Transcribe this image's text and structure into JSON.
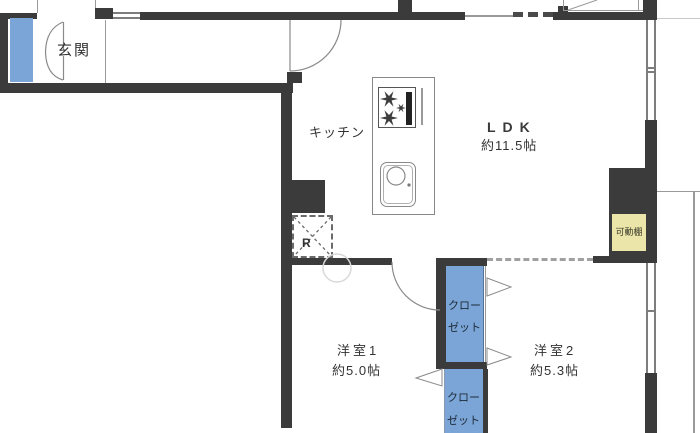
{
  "plan": {
    "entrance": {
      "label": "玄関"
    },
    "kitchen": {
      "label": "キッチン"
    },
    "ldk": {
      "label": "LDK",
      "size": "約11.5帖"
    },
    "room1": {
      "label": "洋室1",
      "size": "約5.0帖"
    },
    "room2": {
      "label": "洋室2",
      "size": "約5.3帖"
    },
    "closets": [
      {
        "line1": "クロー",
        "line2": "ゼット"
      },
      {
        "line1": "クロー",
        "line2": "ゼット"
      }
    ],
    "shelf": {
      "label": "可動棚"
    },
    "refrigerator": {
      "label": "R"
    },
    "colors": {
      "wall": "#3b3b3b",
      "fixture_blue": "#7aa5d6",
      "shelf_yellow": "#ece5a9",
      "line_gray": "#9a9a9a",
      "text": "#333333"
    }
  }
}
